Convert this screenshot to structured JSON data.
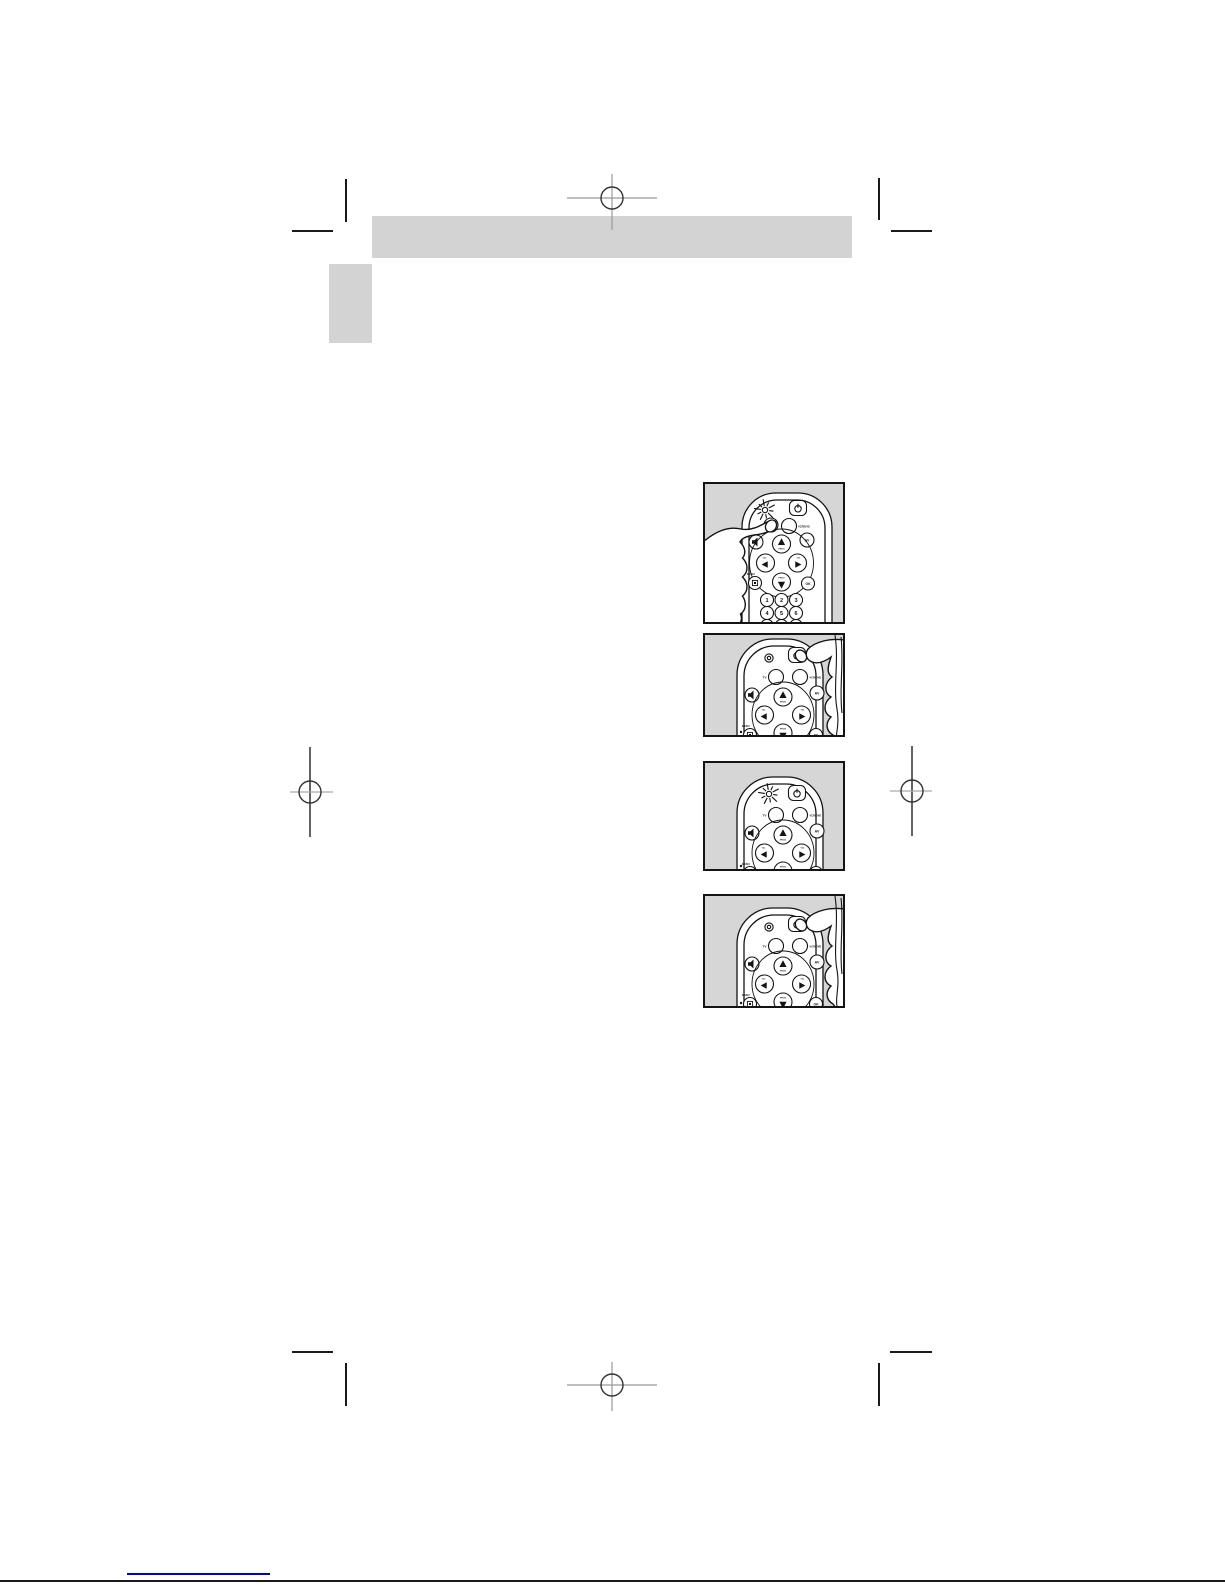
{
  "page": {
    "width": 1225,
    "height": 1585,
    "background": "#ffffff"
  },
  "colors": {
    "panel_gray": "#d3d3d3",
    "figure_gray": "#d6d6d6",
    "ink": "#141414",
    "mark_dark": "#1a1a1a",
    "mark_mid": "#3c3c3c",
    "mark_gray": "#9a9a9a",
    "link_blue": "#0000d4"
  },
  "figures": [
    {
      "step": 1,
      "hand": "left",
      "led_blinking": true,
      "buttons_row": [
        "VCR/DVD"
      ],
      "show_digits": true
    },
    {
      "step": 2,
      "hand": "right",
      "led_blinking": false,
      "buttons_row": [
        "TV",
        "VCR/DVD"
      ],
      "show_digits": false
    },
    {
      "step": 3,
      "hand": "none",
      "led_blinking": true,
      "buttons_row": [
        "TV",
        "VCR/DVD"
      ],
      "show_digits": false
    },
    {
      "step": 4,
      "hand": "right",
      "led_blinking": false,
      "buttons_row": [
        "TV",
        "VCR/DVD"
      ],
      "show_digits": false
    }
  ],
  "remote_labels": {
    "tv": "TV",
    "vcr_dvd": "VCR/DVD",
    "av": "AV",
    "ok": "OK",
    "menu": "MENU",
    "prog": "PROG",
    "vol": "VOL",
    "digits": [
      "1",
      "2",
      "3",
      "4",
      "5",
      "6",
      "7",
      "8",
      "9"
    ]
  }
}
